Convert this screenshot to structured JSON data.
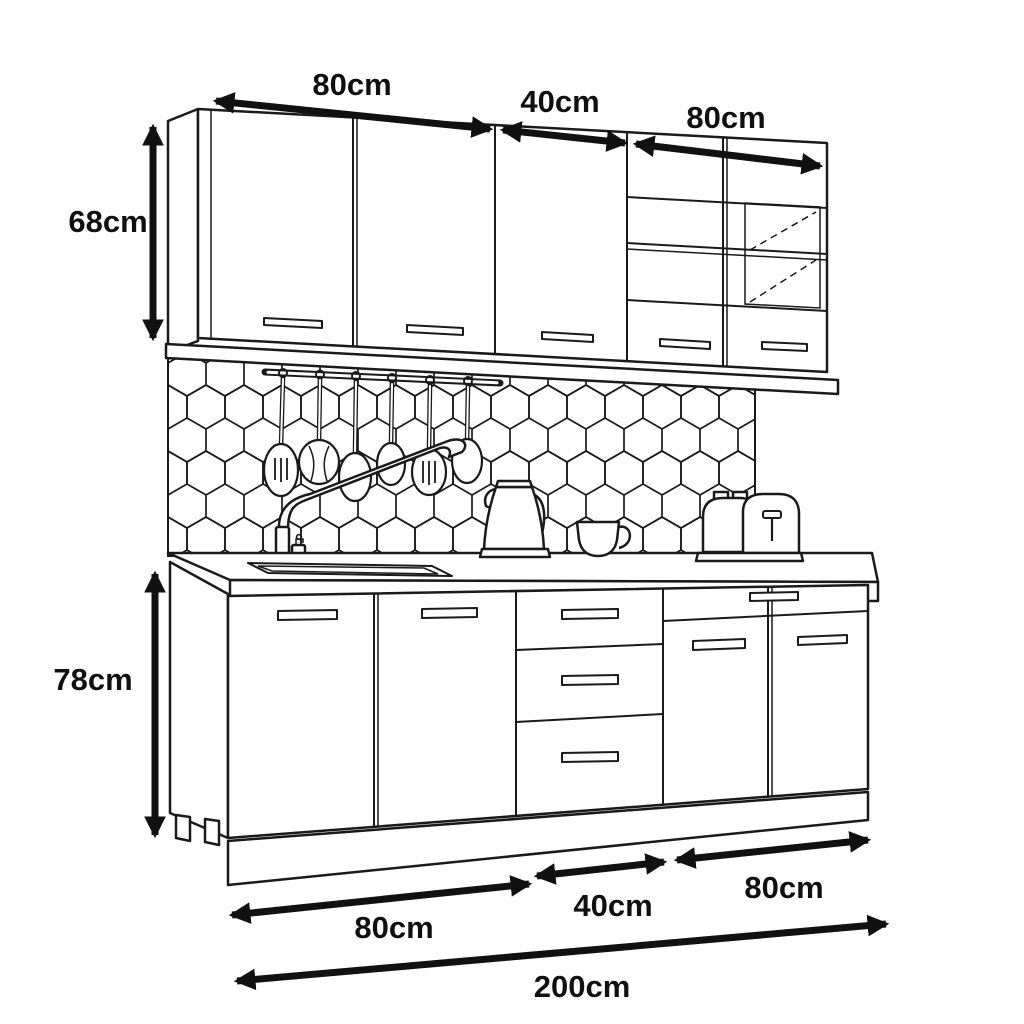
{
  "diagram": {
    "subject": "Kitchen cabinet set with dimensions",
    "style": "black and white technical line drawing",
    "background_color": "#ffffff",
    "line_color": "#1a1a1a",
    "text_color": "#101010"
  },
  "dimensions": {
    "unit": "cm",
    "top": {
      "left": "80cm",
      "middle": "40cm",
      "right": "80cm"
    },
    "side": {
      "upper": "68cm",
      "lower": "78cm"
    },
    "bottom": {
      "left": "80cm",
      "middle": "40cm",
      "right": "80cm",
      "total": "200cm"
    }
  },
  "scene": {
    "wall_units": [
      "80cm two-door cabinet",
      "40cm single-door cabinet",
      "80cm two-door glass display cabinet with shelf"
    ],
    "base_units": [
      "80cm two-door cabinet with sink",
      "40cm three-drawer unit",
      "80cm unit with top drawer and two doors"
    ],
    "decor": [
      "hexagon tile backsplash",
      "hanging rail with six utensils",
      "faucet",
      "soap dispenser",
      "sink",
      "kettle",
      "mug",
      "toaster",
      "plinth",
      "adjustable legs"
    ]
  }
}
